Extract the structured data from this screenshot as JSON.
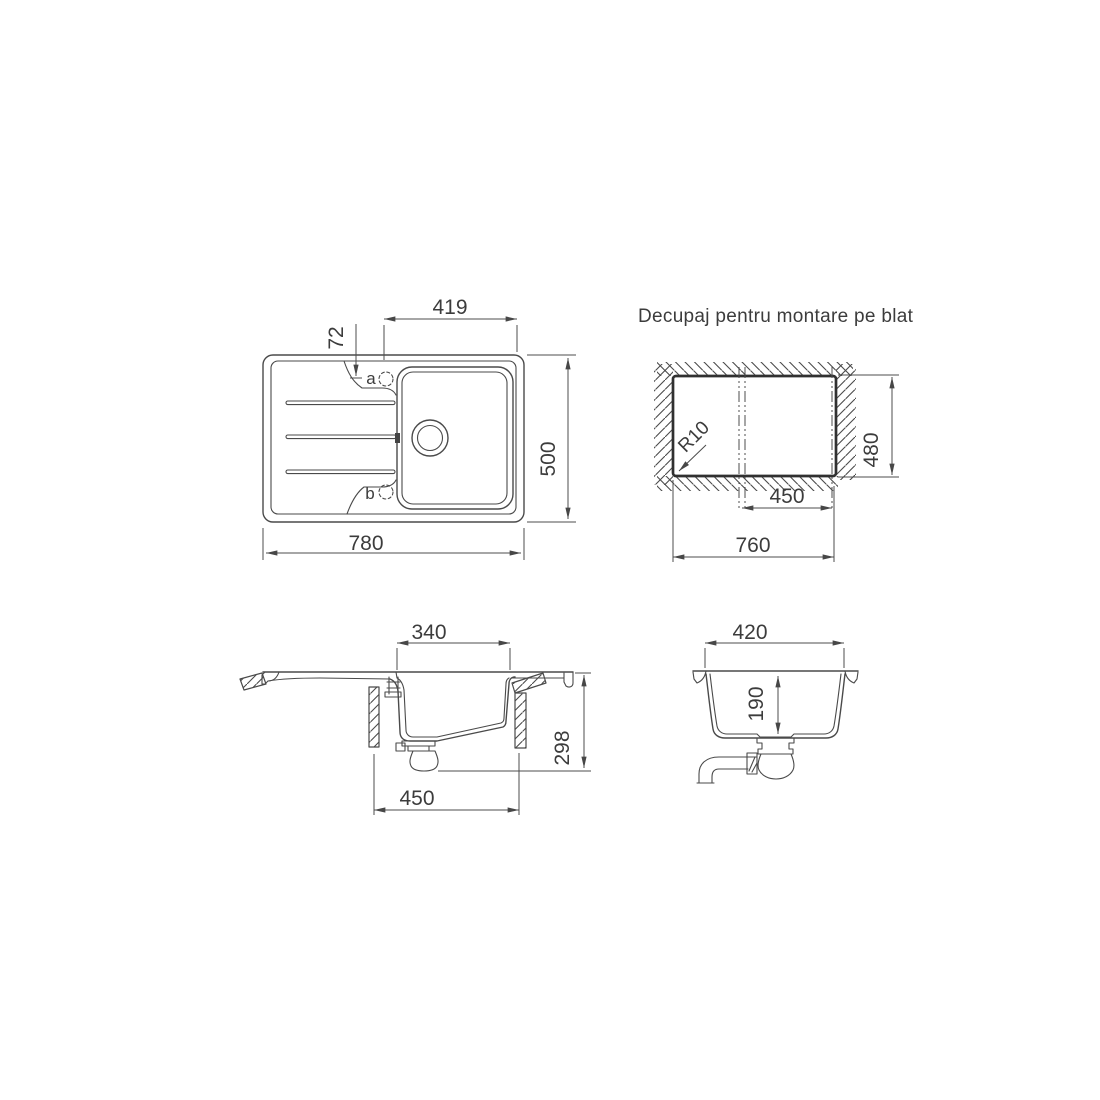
{
  "title": "Decupaj pentru montare pe blat",
  "top_view": {
    "dim_basin_to_edge": "419",
    "dim_hole_offset": "72",
    "dim_width": "780",
    "dim_height": "500",
    "hole_a_label": "a",
    "hole_b_label": "b"
  },
  "cutout_view": {
    "dim_width": "760",
    "dim_height": "480",
    "dim_center_to_edge": "450",
    "corner_radius_label": "R10"
  },
  "side_view": {
    "dim_basin_top": "340",
    "dim_total_height": "298",
    "dim_drain_span": "450"
  },
  "front_view": {
    "dim_width": "420",
    "dim_bowl_depth": "190"
  },
  "colors": {
    "line": "#4a4a4a",
    "bold_line": "#303030",
    "text": "#3c3c3c",
    "background": "#ffffff"
  }
}
